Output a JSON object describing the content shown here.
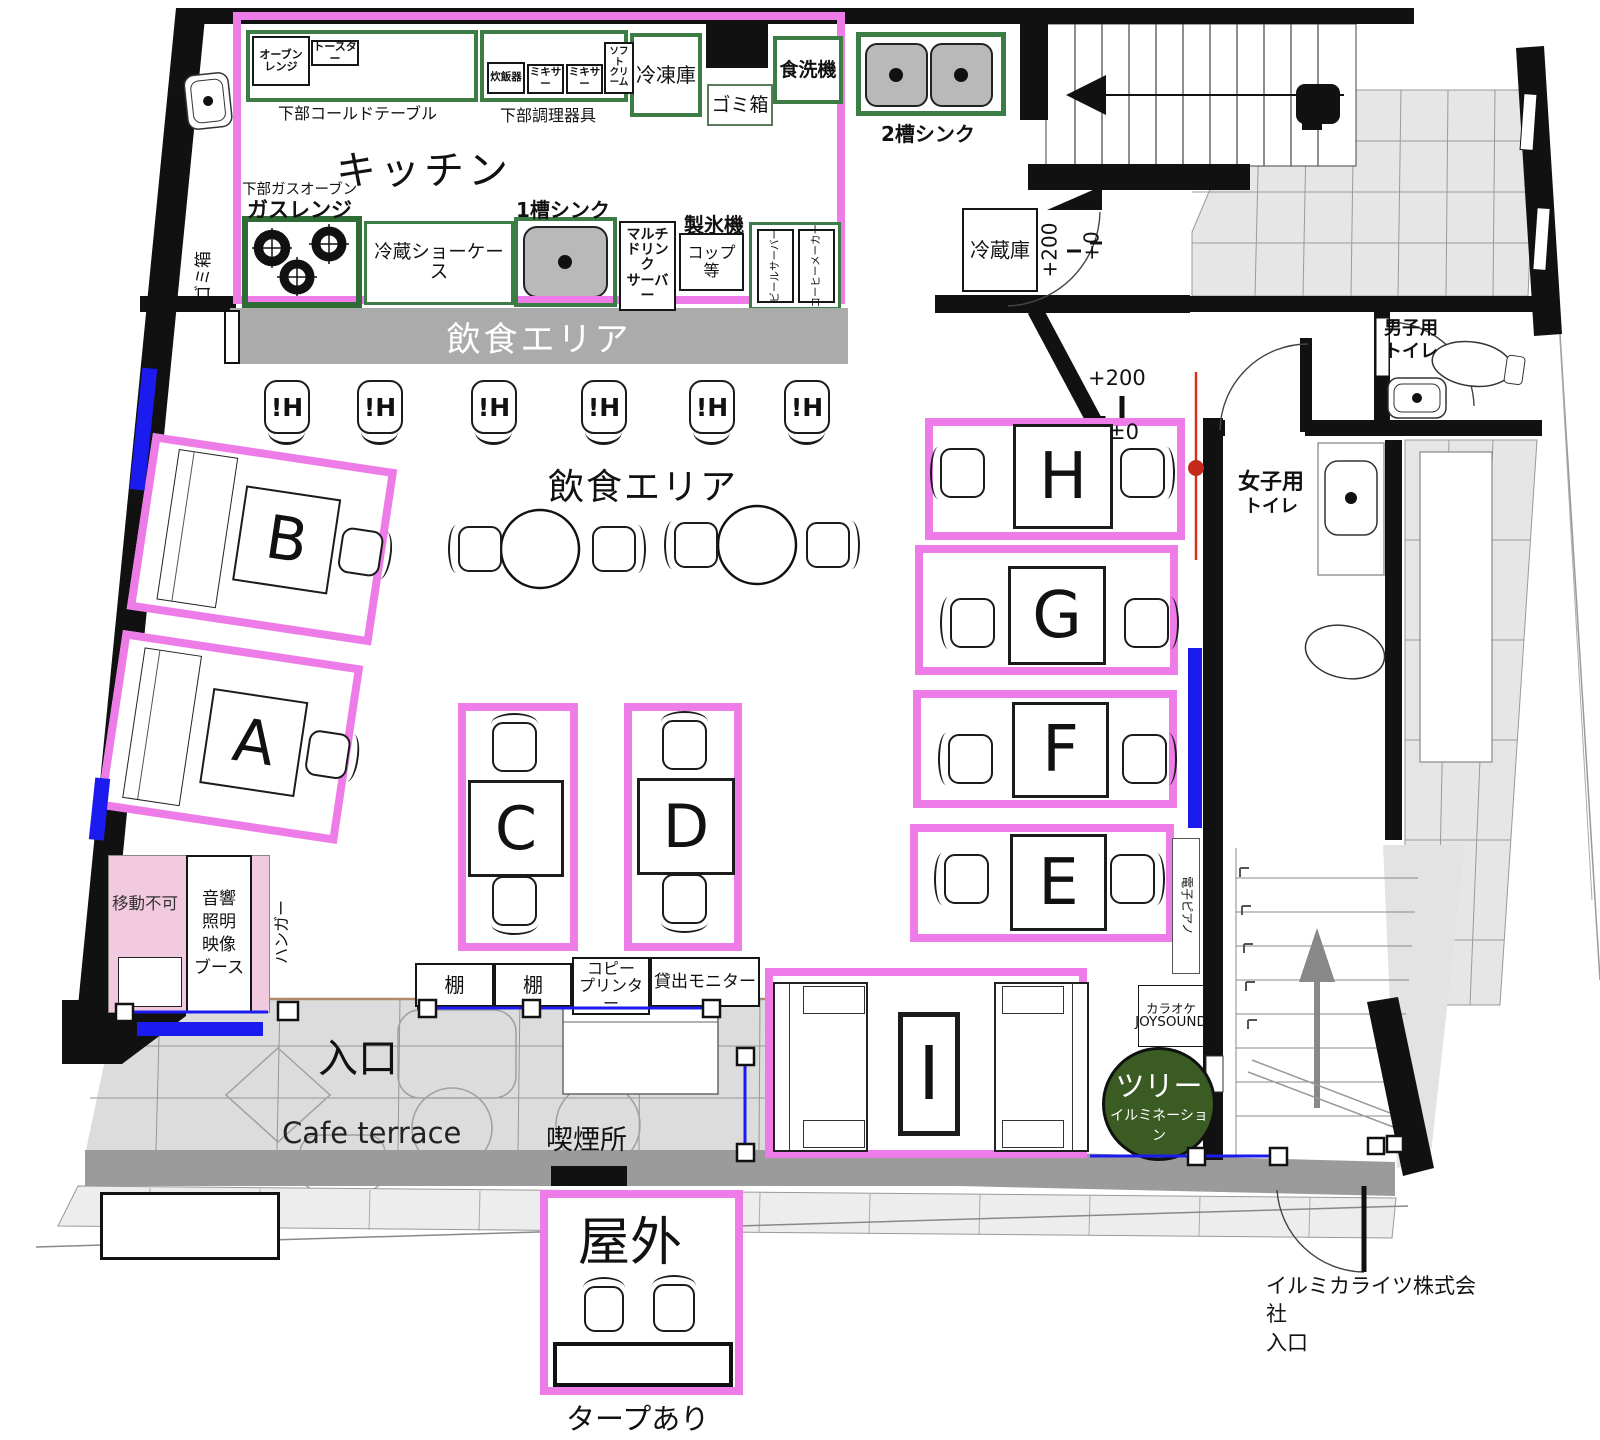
{
  "colors": {
    "frame_pink": "#ee7ce8",
    "equipment_green": "#3c7d46",
    "marker_blue": "#1b1bf0",
    "tree_green": "#3a5b22",
    "booth_pink": "#f2cadf",
    "dining_bar_gray": "#ababab",
    "survey_red": "#c5291b"
  },
  "kitchen": {
    "title": "キッチン",
    "cold_table_label": "下部コールドテーブル",
    "oven_range": "オーブンレンジ",
    "toaster": "トースター",
    "utensils_label": "下部調理器具",
    "rice_cooker": "炊飯器",
    "mixer_1": "ミキサー",
    "mixer_2": "ミキサー",
    "soft_cream_lines": [
      "ソフト",
      "クリーム"
    ],
    "freezer": "冷凍庫",
    "trash_box": "ゴミ箱",
    "dishwasher": "食洗機",
    "double_sink": "2槽シンク",
    "gas_oven_note": "下部ガスオーブン",
    "gas_range": "ガスレンジ",
    "refrigerated_showcase": "冷蔵ショーケース",
    "single_sink": "1槽シンク",
    "drink_server_lines": [
      "マルチ",
      "ドリンク",
      "サーバー"
    ],
    "ice_maker": "製氷機",
    "cups": "コップ等",
    "beer_server": "ビールサーバー",
    "coffee_maker": "コーヒーメーカー",
    "wall_trash": "ゴミ箱"
  },
  "dining": {
    "bar_label": "飲食エリア",
    "center_label": "飲食エリア",
    "stools": [
      "!H",
      "!H",
      "!H",
      "!H",
      "!H",
      "!H"
    ]
  },
  "tables": {
    "a": "A",
    "b": "B",
    "c": "C",
    "d": "D",
    "e": "E",
    "f": "F",
    "g": "G",
    "h": "H",
    "i": "I"
  },
  "rooms": {
    "refrigerator": "冷蔵庫",
    "mens_toilet_lines": [
      "男子用",
      "トイレ"
    ],
    "womens_toilet_lines": [
      "女子用",
      "トイレ"
    ]
  },
  "booth": {
    "fixed": "移動不可",
    "lines": [
      "音響",
      "照明",
      "映像",
      "ブース"
    ],
    "hanger": "ハンガー"
  },
  "equipment": {
    "shelf_1": "棚",
    "shelf_2": "棚",
    "copy_printer_lines": [
      "コピー",
      "プリンター"
    ],
    "rental_monitor": "貸出モニター",
    "karaoke_lines": [
      "カラオケ",
      "JOYSOUND"
    ],
    "electric_piano": "電子ピアノ",
    "tree_lines": [
      "ツリー",
      "イルミネーション"
    ]
  },
  "levels": {
    "door_plus200": "+200",
    "door_plus0": "+0",
    "hall_plus200": "+200",
    "hall_pm0": "±0"
  },
  "outdoor": {
    "entrance": "入口",
    "cafe_terrace": "Cafe terrace",
    "smoking_area": "喫煙所",
    "outside": "屋外",
    "tarp_note": "タープあり",
    "company_lines": [
      "イルミカライツ株式会社",
      "入口"
    ]
  }
}
